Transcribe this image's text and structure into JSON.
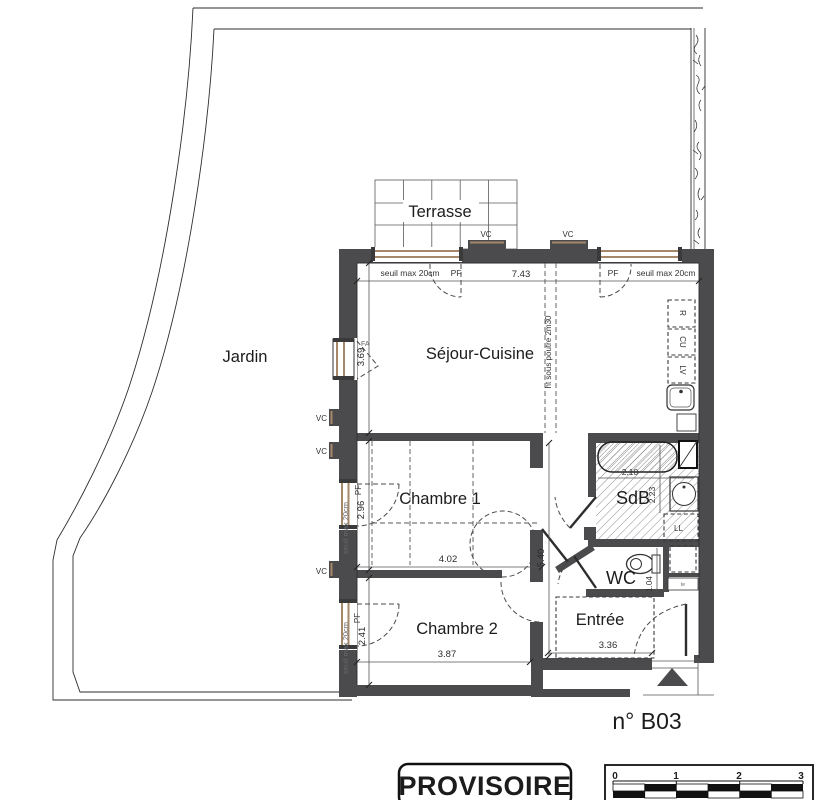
{
  "plan": {
    "labels": {
      "jardin": "Jardin",
      "terrasse": "Terrasse",
      "sejour": "Séjour-Cuisine",
      "chambre1": "Chambre 1",
      "chambre2": "Chambre 2",
      "sdb": "SdB",
      "wc": "WC",
      "entree": "Entrée"
    },
    "dims": {
      "sejour_w": "7.43",
      "sejour_d": "3.69",
      "ch1_w": "4.02",
      "ch1_d": "2.96",
      "ch2_w": "3.87",
      "ch2_d": "2.41",
      "hall_d": "5.40",
      "sdb_w": "2.10",
      "sdb_d": "2.23",
      "wc_d": "1.04",
      "entree_w": "3.36"
    },
    "notes": {
      "threshold": "seuil max 20cm",
      "beam": "ht sous poutre 2m30"
    },
    "openings": {
      "pf": "PF",
      "fa": "FA",
      "vc": "VC"
    },
    "fixtures": {
      "fridge": "R",
      "cooktop": "CU",
      "dishwasher": "LV",
      "washer": "LL",
      "tech": "te"
    },
    "footer": {
      "unit": "n° B03",
      "stamp": "PROVISOIRE",
      "scale_ticks": [
        "0",
        "1",
        "2",
        "3"
      ]
    },
    "colors": {
      "wall": "#4b4b4d",
      "sill": "#a5876a"
    }
  }
}
